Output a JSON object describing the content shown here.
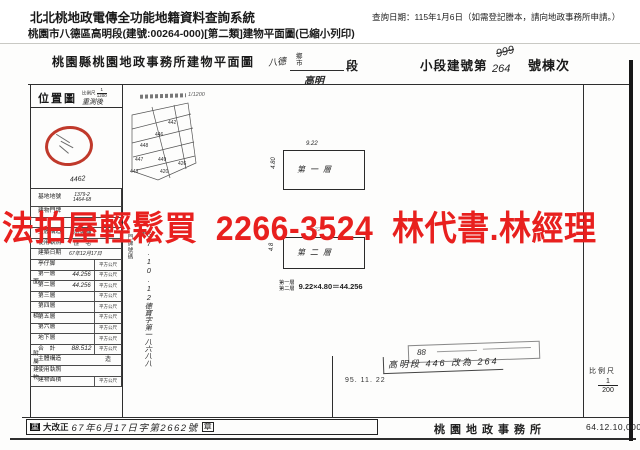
{
  "header": {
    "system_title": "北北桃地政電傳全功能地籍資料查詢系統",
    "query_date": "查詢日期：115年1月6日（如需登記謄本，請向地政事務所申請。）",
    "subtitle": "桃園市八德區高明段(建號:00264-000)[第二類]建物平面圖(已縮小列印)"
  },
  "doc": {
    "title": "桃園縣桃園地政事務所建物平面圖",
    "admin_hand": "八德",
    "admin_xiang": "鄉",
    "admin_shi": "市",
    "section_hand": "高明",
    "section_label": "段",
    "bno_prefix": "小段建號第",
    "bno_old": "999",
    "bno_new": "264",
    "bno_suffix": "號棟次"
  },
  "location_map": {
    "title": "位置圖",
    "scale_label": "比例尺",
    "scale_num": "1",
    "scale_den": "1200",
    "note_top": "重測後",
    "note_bottom": "4462"
  },
  "info_table": {
    "side_area": "面積",
    "side_annex": "附屬建物",
    "rows": [
      {
        "label": "基地地號",
        "value": "1379-2",
        "value2": "1464-68",
        "unit": ""
      },
      {
        "label": "建物門牌",
        "value": "",
        "unit": ""
      },
      {
        "label": "",
        "value": "",
        "unit": ""
      },
      {
        "label": "主體構造",
        "value": "加強磚",
        "unit": "造"
      },
      {
        "label": "使用執照",
        "value": "住　宅",
        "unit": ""
      },
      {
        "label": "建築日期",
        "value": "67年12月17日",
        "unit": ""
      },
      {
        "label": "亭仔脚",
        "value": "",
        "unit": "平方公尺"
      },
      {
        "label": "第一層",
        "value": "44.256",
        "unit": "平方公尺"
      },
      {
        "label": "第二層",
        "value": "44.256",
        "unit": "平方公尺"
      },
      {
        "label": "第三層",
        "value": "",
        "unit": "平方公尺"
      },
      {
        "label": "第四層",
        "value": "",
        "unit": "平方公尺"
      },
      {
        "label": "第五層",
        "value": "",
        "unit": "平方公尺"
      },
      {
        "label": "第六層",
        "value": "",
        "unit": "平方公尺"
      },
      {
        "label": "地下層",
        "value": "",
        "unit": "平方公尺"
      },
      {
        "label": "合　計",
        "value": "88.512",
        "unit": "平方公尺"
      },
      {
        "label": "主體構造",
        "value": "",
        "unit": "造"
      },
      {
        "label": "使用執照",
        "value": "",
        "unit": ""
      },
      {
        "label": "建物面積",
        "value": "",
        "unit": "平方公尺"
      }
    ]
  },
  "plan": {
    "sketch_note": "1/1200",
    "lots": [
      "442",
      "446",
      "448",
      "447",
      "449",
      "426",
      "448",
      "420"
    ],
    "floor1_label": "第一層",
    "floor2_label": "第二層",
    "dim_width": "9.22",
    "dim_height": "4.80",
    "dim_height2": "4.8",
    "calc_f1": "第一層",
    "calc_f2": "第二層",
    "calc_expr": "9.22×4.80＝44.256",
    "address_vlabel": "門牌號碼",
    "license_vnote": "67.10.12德寶字第一八六八八號",
    "survey_date": "95. 11. 22",
    "stamp_year": "88",
    "stamp_note": "高明段 446 改為 264"
  },
  "footer": {
    "scale_label": "比例尺",
    "scale_num": "1",
    "scale_den": "200",
    "office": "桃園地政事務所",
    "print_code": "64.12.10,000",
    "revision_head": "重",
    "revision_rest": "大改正",
    "revision_hand": "67年6月17日字第2662號",
    "revision_seal": "章"
  },
  "watermark": {
    "text": "法拍屋輕鬆買  2266-3524  林代書.林經理",
    "color": "#e8201e"
  }
}
